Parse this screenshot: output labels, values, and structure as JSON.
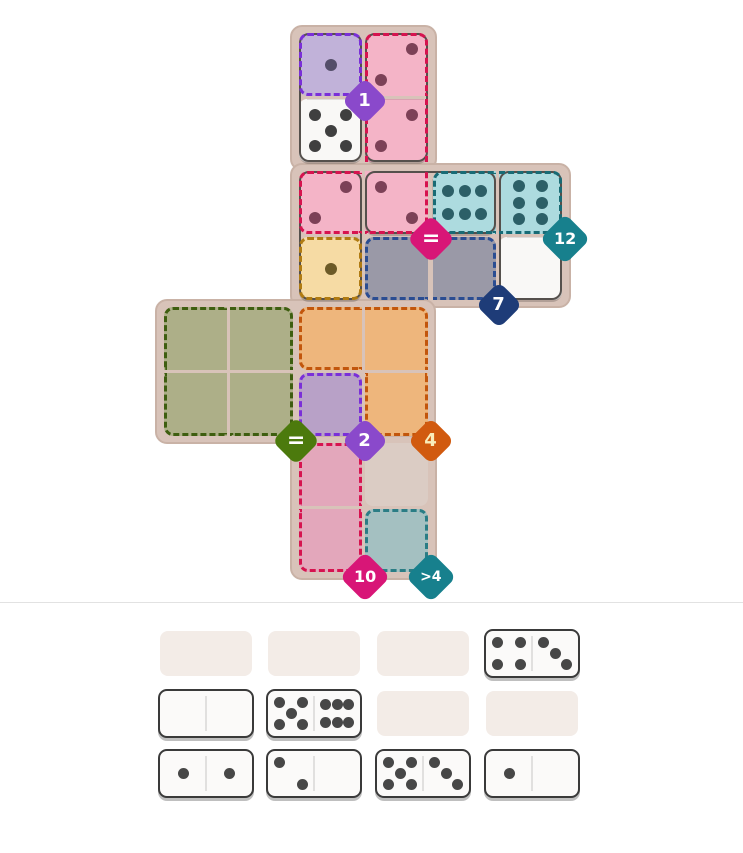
{
  "board": {
    "panel_fill": "#d8c3b9",
    "panel_border": "#c9b2a6",
    "domino_fill": "#f9f8f6",
    "domino_border": "#55504c",
    "default_pip_color": "#3f3f3f",
    "regions": [
      {
        "name": "purple-1",
        "cells": [
          "C1"
        ],
        "fill": "#c1b2d9",
        "dash": "#7a2fd8",
        "pip_color": "#544e69",
        "badge": {
          "label": "1",
          "color": "#8a49cb",
          "text_color": "#ffffff",
          "anchor_cell": "C1",
          "font": 18,
          "side": 33
        }
      },
      {
        "name": "pink-equal",
        "cells": [
          "D1",
          "D2",
          "C3",
          "D3"
        ],
        "fill": "#f4b4c7",
        "dash": "#d6134f",
        "pip_color": "#7c4157",
        "badge": {
          "label": "=",
          "color": "#d81677",
          "text_color": "#ffffff",
          "anchor_cell": "D3",
          "font": 22,
          "side": 34
        }
      },
      {
        "name": "teal-12",
        "cells": [
          "E3",
          "F3"
        ],
        "fill": "#addbdf",
        "dash": "#186b75",
        "pip_color": "#2c5f67",
        "badge": {
          "label": "12",
          "color": "#17808d",
          "text_color": "#ffffff",
          "anchor_cell": "F3",
          "font": 16,
          "side": 36
        }
      },
      {
        "name": "yellow-plain",
        "cells": [
          "C4"
        ],
        "fill": "#f6dba4",
        "dash": "#b07b12",
        "pip_color": "#6c5a27",
        "badge": null
      },
      {
        "name": "slate-7",
        "cells": [
          "D4",
          "E4"
        ],
        "fill": "#9a99a7",
        "dash": "#2b4d92",
        "pip_color": "#3f3f3f",
        "badge": {
          "label": "7",
          "color": "#1e3c78",
          "text_color": "#ffffff",
          "anchor_cell": "E4",
          "font": 18,
          "side": 33
        }
      },
      {
        "name": "green-equal",
        "cells": [
          "A5",
          "B5",
          "A6",
          "B6"
        ],
        "fill": "#adaf88",
        "dash": "#3e5e10",
        "pip_color": "#3f3f3f",
        "badge": {
          "label": "=",
          "color": "#4c7a0d",
          "text_color": "#ffffff",
          "anchor_cell": "B6",
          "font": 22,
          "side": 34
        }
      },
      {
        "name": "orange-4",
        "cells": [
          "C5",
          "D5",
          "D6"
        ],
        "fill": "#eeb67c",
        "dash": "#c2560c",
        "pip_color": "#3f3f3f",
        "badge": {
          "label": "4",
          "color": "#d15a0f",
          "text_color": "#f9edbb",
          "anchor_cell": "D6",
          "font": 18,
          "side": 33
        }
      },
      {
        "name": "purple-2",
        "cells": [
          "C6"
        ],
        "fill": "#b8a1c7",
        "dash": "#7a2fd8",
        "pip_color": "#3f3f3f",
        "badge": {
          "label": "2",
          "color": "#8a49cb",
          "text_color": "#ffffff",
          "anchor_cell": "C6",
          "font": 18,
          "side": 33
        }
      },
      {
        "name": "pink-10",
        "cells": [
          "C7",
          "C8"
        ],
        "fill": "#e3a7bb",
        "dash": "#d6134f",
        "pip_color": "#3f3f3f",
        "badge": {
          "label": "10",
          "color": "#d81677",
          "text_color": "#ffffff",
          "anchor_cell": "C8",
          "font": 16,
          "side": 36
        }
      },
      {
        "name": "teal-gt4",
        "cells": [
          "D8"
        ],
        "fill": "#a4c0c1",
        "dash": "#2a7d85",
        "pip_color": "#3f3f3f",
        "badge": {
          "label": ">4",
          "color": "#17808d",
          "text_color": "#ffffff",
          "anchor_cell": "D8",
          "font": 14,
          "side": 36
        }
      }
    ],
    "plain_cells": [
      {
        "cell": "D7",
        "fill": "#dbccc4"
      }
    ],
    "placed_dominoes": [
      {
        "name": "domino-1-5",
        "halves": [
          {
            "cell": "C1",
            "pips": 1
          },
          {
            "cell": "C2",
            "pips": 5
          }
        ]
      },
      {
        "name": "domino-2-2",
        "halves": [
          {
            "cell": "D1",
            "pips": 2,
            "style": "tr"
          },
          {
            "cell": "D2",
            "pips": 2,
            "style": "tr"
          }
        ]
      },
      {
        "name": "domino-2-1",
        "halves": [
          {
            "cell": "C3",
            "pips": 2,
            "style": "tr"
          },
          {
            "cell": "C4",
            "pips": 1
          }
        ]
      },
      {
        "name": "domino-2-6",
        "halves": [
          {
            "cell": "D3",
            "pips": 2,
            "style": "tl"
          },
          {
            "cell": "E3",
            "pips": 6,
            "style": "rows"
          }
        ]
      },
      {
        "name": "domino-6-0",
        "halves": [
          {
            "cell": "F3",
            "pips": 6,
            "style": "cols"
          },
          {
            "cell": "F4",
            "pips": 0
          }
        ]
      }
    ]
  },
  "tray": {
    "slot_color": "#f3ece7",
    "domino_fill": "#fbfaf9",
    "domino_border": "#3a3a3a",
    "pip_color": "#474747",
    "rows": [
      [
        null,
        null,
        null,
        {
          "name": "tray-domino-4-3",
          "pips": [
            4,
            3
          ],
          "styles": [
            null,
            "tl"
          ]
        }
      ],
      [
        {
          "name": "tray-domino-0-0",
          "pips": [
            0,
            0
          ],
          "styles": [
            null,
            null
          ]
        },
        {
          "name": "tray-domino-5-6",
          "pips": [
            5,
            6
          ],
          "styles": [
            null,
            "rows"
          ]
        },
        null,
        null
      ],
      [
        {
          "name": "tray-domino-1-1",
          "pips": [
            1,
            1
          ],
          "styles": [
            null,
            null
          ]
        },
        {
          "name": "tray-domino-2-0",
          "pips": [
            2,
            0
          ],
          "styles": [
            "tl",
            null
          ]
        },
        {
          "name": "tray-domino-5-3",
          "pips": [
            5,
            3
          ],
          "styles": [
            null,
            "tl"
          ]
        },
        {
          "name": "tray-domino-1-0",
          "pips": [
            1,
            0
          ],
          "styles": [
            null,
            null
          ]
        }
      ]
    ]
  },
  "divider_color": "#e2e2e2"
}
